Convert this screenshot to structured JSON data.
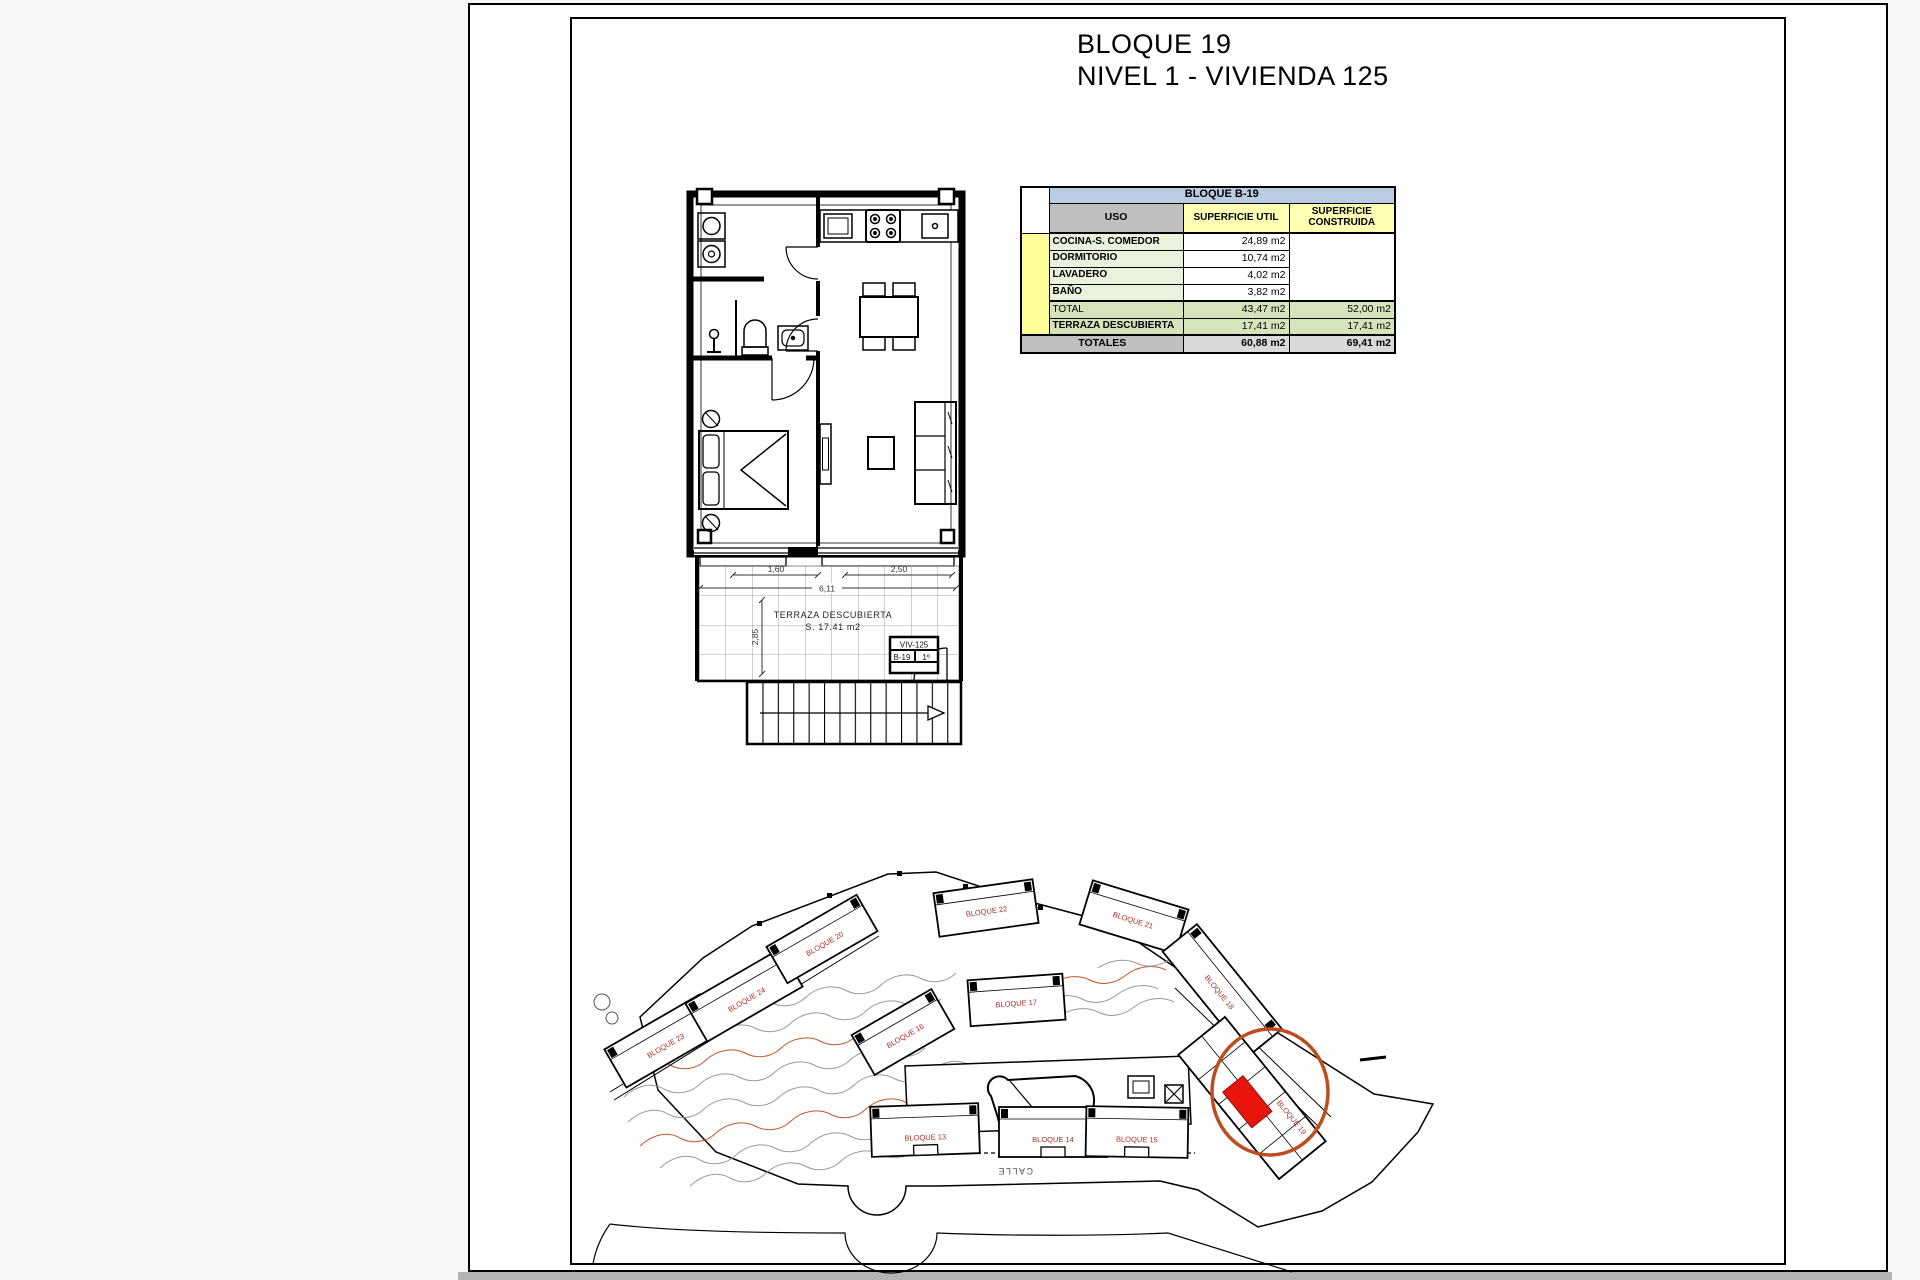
{
  "page": {
    "title_line1": "BLOQUE 19",
    "title_line2": "NIVEL 1 - VIVIENDA 125"
  },
  "table": {
    "block_header": "BLOQUE B-19",
    "col_uso": "USO",
    "col_util": "SUPERFICIE UTIL",
    "col_construida": "SUPERFICIE CONSTRUIDA",
    "vivienda": "VIVIENDA 125",
    "rows": [
      {
        "label": "COCINA-S. COMEDOR",
        "util": "24,89 m2"
      },
      {
        "label": "DORMITORIO",
        "util": "10,74 m2"
      },
      {
        "label": "LAVADERO",
        "util": "4,02 m2"
      },
      {
        "label": "BAÑO",
        "util": "3,82 m2"
      }
    ],
    "total": {
      "label": "TOTAL",
      "util": "43,47 m2",
      "construida": "52,00 m2"
    },
    "terraza": {
      "label": "TERRAZA DESCUBIERTA",
      "util": "17,41 m2",
      "construida": "17,41 m2"
    },
    "totales": {
      "label": "TOTALES",
      "util": "60,88 m2",
      "construida": "69,41 m2"
    }
  },
  "floorplan": {
    "terraza_title": "TERRAZA DESCUBIERTA",
    "terraza_area": "S. 17.41 m2",
    "dims": {
      "window_left": "1,60",
      "window_right": "2,50",
      "total_width": "6,11",
      "depth": "2,85"
    },
    "tag": {
      "unit": "VIV-125",
      "block": "B-19",
      "level": "1º"
    }
  },
  "siteplan": {
    "street": "CALLE",
    "blocks": [
      {
        "label": "BLOQUE 23"
      },
      {
        "label": "BLOQUE 24"
      },
      {
        "label": "BLOQUE 20"
      },
      {
        "label": "BLOQUE 22"
      },
      {
        "label": "BLOQUE 21"
      },
      {
        "label": "BLOQUE 16"
      },
      {
        "label": "BLOQUE 17"
      },
      {
        "label": "BLOQUE 18"
      },
      {
        "label": "BLOQUE 13"
      },
      {
        "label": "BLOQUE 14"
      },
      {
        "label": "BLOQUE 15"
      },
      {
        "label": "BLOQUE 19"
      }
    ]
  },
  "colors": {
    "highlight_fill": "#e8150c",
    "highlight_ring": "#bf4c1e",
    "block_label": "#a93226",
    "header_blue": "#b9cce2",
    "header_gray": "#bfbfbf",
    "header_yellow": "#ffffb3",
    "vivienda_yellow": "#ffff99",
    "row_green_light": "#eaf1dd",
    "row_green": "#d6e4bc",
    "totales_gray": "#d9d9d9"
  }
}
